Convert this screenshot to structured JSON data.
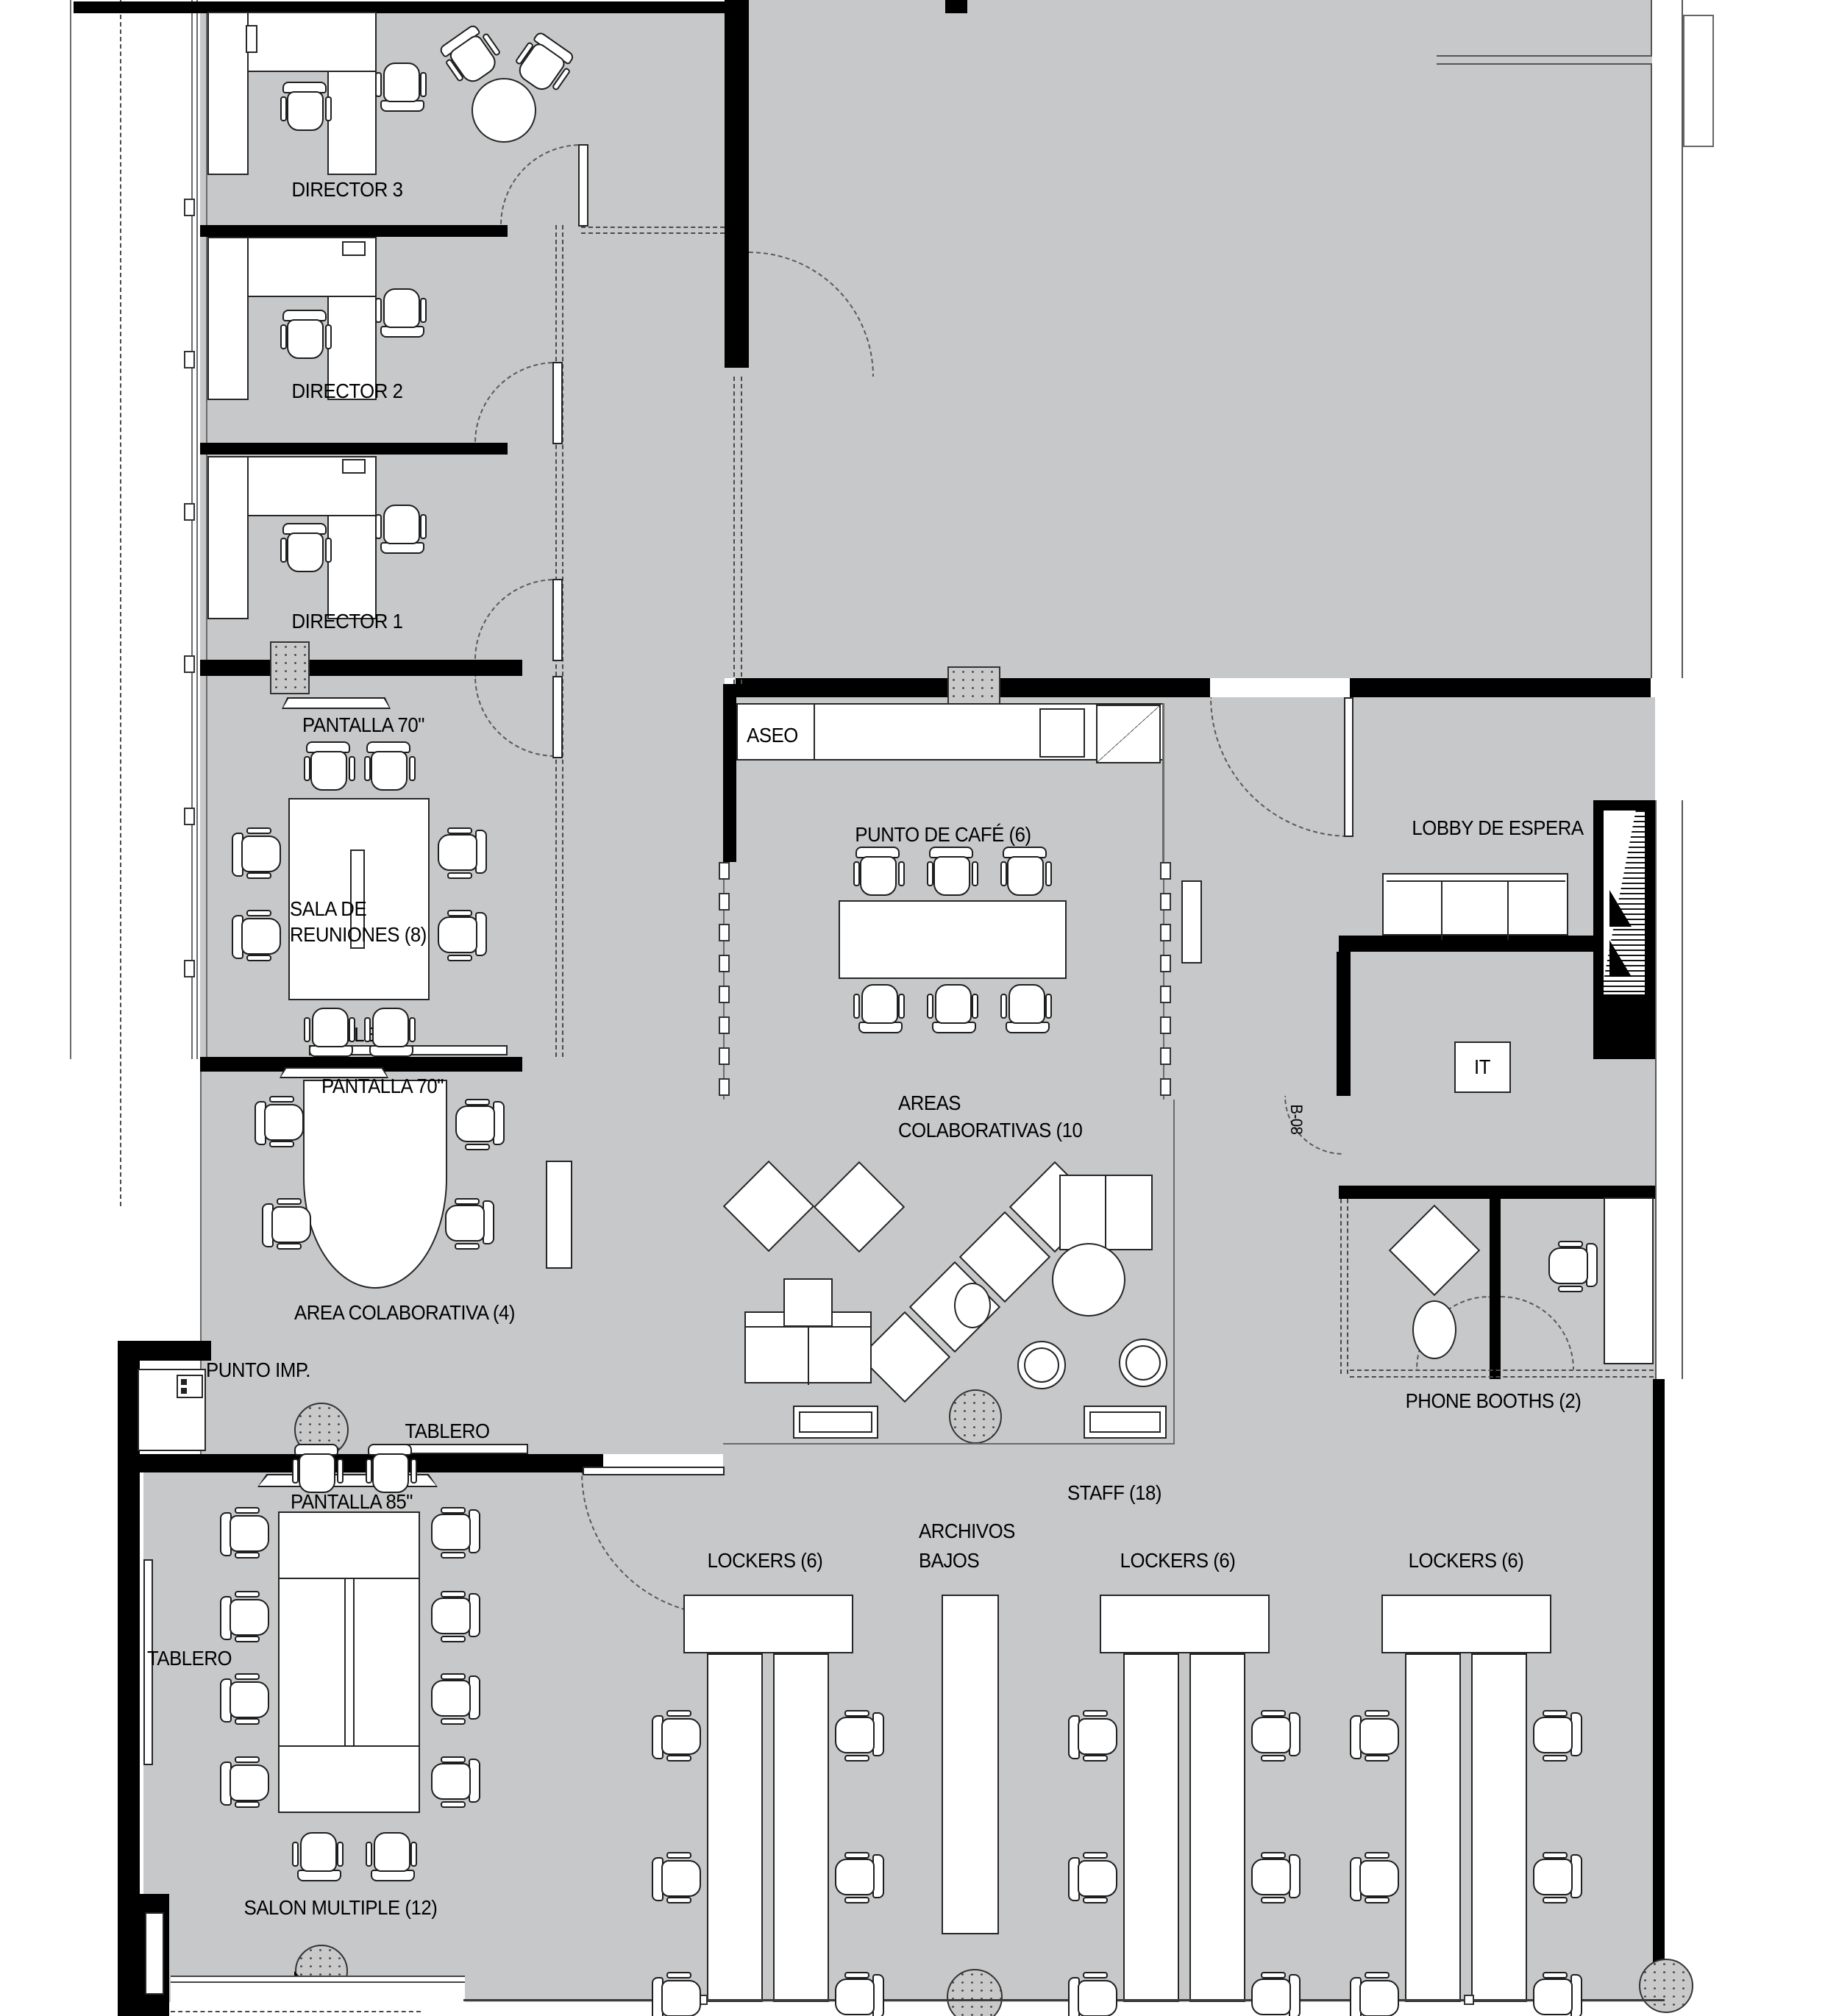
{
  "title": "Office floor plan",
  "colors": {
    "floor": "#c7c8c9",
    "wall": "#000000",
    "line": "#3c3c3c"
  },
  "rooms": {
    "director3": {
      "label": "DIRECTOR 3"
    },
    "director2": {
      "label": "DIRECTOR 2"
    },
    "director1": {
      "label": "DIRECTOR 1"
    },
    "sala_reuniones": {
      "line1": "SALA DE",
      "line2": "REUNIONES (8)"
    },
    "area_colaborativa": {
      "label": "AREA COLABORATIVA (4)"
    },
    "punto_imp": {
      "label": "PUNTO IMP."
    },
    "salon_multiple": {
      "label": "SALON MULTIPLE (12)"
    },
    "aseo": {
      "label": "ASEO"
    },
    "punto_cafe": {
      "label": "PUNTO DE CAFÉ (6)"
    },
    "areas_colaborativas": {
      "line1": "AREAS",
      "line2": "COLABORATIVAS (10"
    },
    "lobby": {
      "label": "LOBBY DE ESPERA"
    },
    "it": {
      "label": "IT"
    },
    "phone_booths": {
      "label": "PHONE BOOTHS (2)"
    },
    "staff": {
      "label": "STAFF (18)"
    },
    "lockers1": {
      "label": "LOCKERS (6)"
    },
    "lockers2": {
      "label": "LOCKERS (6)"
    },
    "lockers3": {
      "label": "LOCKERS (6)"
    },
    "archivos": {
      "line1": "ARCHIVOS",
      "line2": "BAJOS"
    }
  },
  "equipment": {
    "pantalla70_sala": "PANTALLA 70\"",
    "pantalla70_area": "PANTALLA 70\"",
    "pantalla85": "PANTALLA 85\"",
    "tablero_sala": "TABLERO",
    "tablero_corredor": "TABLERO",
    "tablero_salon": "TABLERO",
    "door_tag": "B-08"
  }
}
